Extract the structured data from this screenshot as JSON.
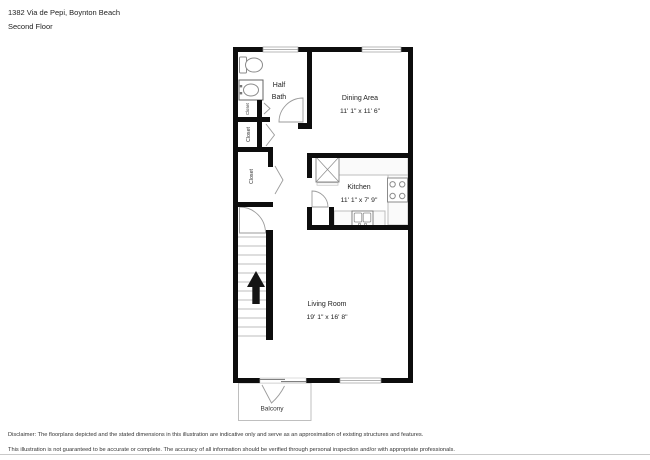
{
  "header": {
    "address": "1382 Via de Pepi, Boynton Beach",
    "floor": "Second Floor"
  },
  "plan": {
    "rooms": {
      "half_bath": {
        "lines": [
          "Half",
          "Bath"
        ]
      },
      "dining": {
        "name": "Dining Area",
        "dims": "11' 1\" x 11' 6\""
      },
      "kitchen": {
        "name": "Kitchen",
        "dims": "11' 1\" x 7' 9\""
      },
      "living": {
        "name": "Living Room",
        "dims": "19' 1\" x 16' 8\""
      },
      "balcony": {
        "name": "Balcony"
      }
    },
    "closets": [
      {
        "label": "Closet"
      },
      {
        "label": "Closet"
      },
      {
        "label": "Closet"
      }
    ],
    "icons": {
      "toilet": "toilet-icon",
      "sink": "sink-icon",
      "refrigerator": "refrigerator-icon",
      "stove": "stove-icon",
      "kitchen_sink": "kitchen-sink-icon",
      "stairs_up_arrow": "stairs-up-arrow-icon"
    },
    "colors": {
      "wall": "#0d0d0d",
      "fixture_outline": "#8b8b8b",
      "counter_fill": "#fafafa",
      "label_text": "#222222"
    }
  },
  "footer": {
    "line1": "Disclaimer: The floorplans depicted and the stated dimensions in this illustration are indicative only and serve as an approximation of existing structures and features.",
    "line2": "This illustration is not guaranteed to be accurate or complete. The accuracy of all information should be verified through personal inspection and/or with appropriate professionals."
  }
}
